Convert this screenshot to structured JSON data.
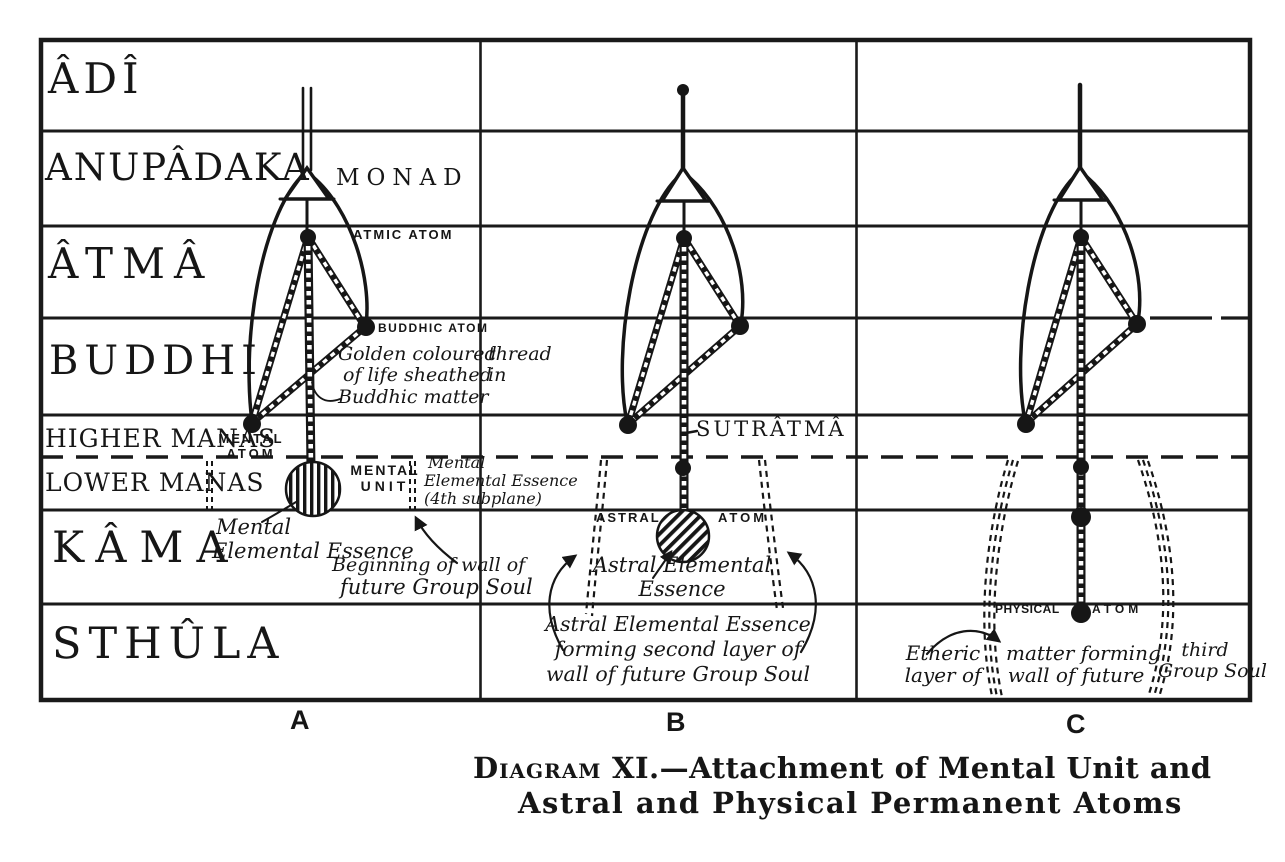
{
  "palette": {
    "ink": "#161616",
    "paper": "#ffffff"
  },
  "planes": [
    {
      "label": "ÂDÎ"
    },
    {
      "label": "ANUPÂDAKA"
    },
    {
      "label": "ÂTMÂ"
    },
    {
      "label": "BUDDHI"
    },
    {
      "label": "HIGHER MANAS"
    },
    {
      "label": "LOWER MANAS"
    },
    {
      "label": "KÂMA"
    },
    {
      "label": "STHÛLA"
    }
  ],
  "columns": [
    {
      "letter": "A"
    },
    {
      "letter": "B"
    },
    {
      "letter": "C"
    }
  ],
  "figure_a": {
    "monad_label": "MONAD",
    "atmic_atom_label": "ATMIC ATOM",
    "buddhic_atom_label": "BUDDHIC ATOM",
    "mental_atom": [
      "MENTAL",
      "ATOM"
    ],
    "mental_unit": [
      "MENTAL",
      "UNIT"
    ],
    "golden_thread_left": [
      "Golden coloured",
      "of life sheathed",
      "Buddhic matter"
    ],
    "golden_thread_right": [
      "thread",
      "in"
    ],
    "mental_essence": [
      "Mental",
      "Elemental Essence"
    ],
    "mental_essence_subplane": [
      "Mental",
      "Elemental Essence",
      "(4th subplane)"
    ],
    "wall_beginning": [
      "Beginning of wall of",
      "future Group Soul"
    ]
  },
  "figure_b": {
    "sutratma_label": "SUTRÂTMÂ",
    "astral_atom_left": "ASTRAL",
    "astral_atom_right": "ATOM",
    "astral_essence": [
      "Astral Elemental",
      "Essence"
    ],
    "wall_second": [
      "Astral Elemental Essence",
      "forming second layer of",
      "wall of future Group Soul"
    ]
  },
  "figure_c": {
    "physical_atom_left": "PHYSICAL",
    "physical_atom_right": "ATOM",
    "etheric": [
      "Etheric",
      "layer of"
    ],
    "matter_forming": [
      "matter forming",
      "wall of future"
    ],
    "third_group": [
      "third",
      "Group Soul"
    ]
  },
  "caption": {
    "diagram_smallcaps": "Diagram",
    "line1_rest": " XI.—Attachment of Mental Unit and",
    "line2": "Astral and Physical Permanent Atoms"
  }
}
